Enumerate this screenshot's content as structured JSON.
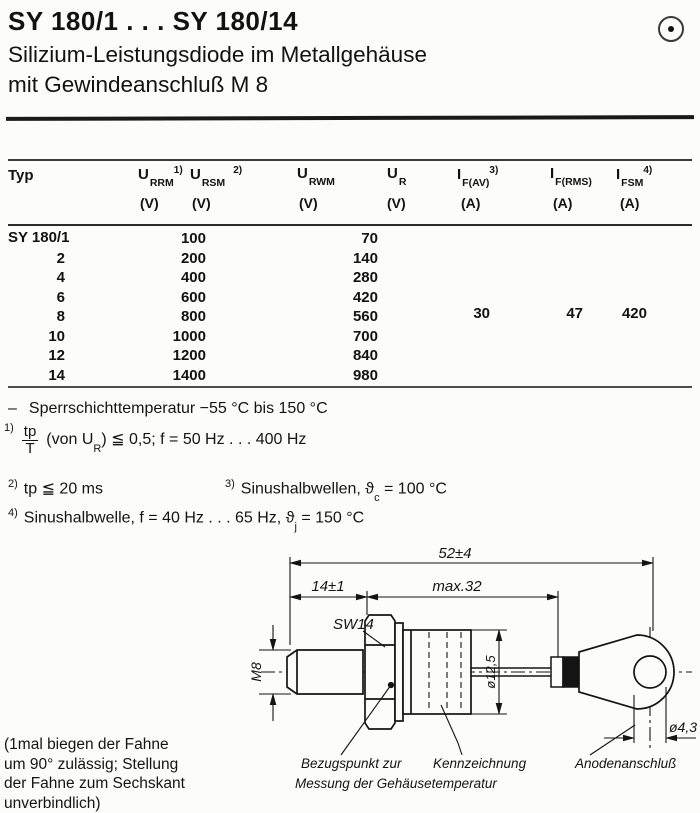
{
  "page": {
    "title": "SY 180/1 . . . SY 180/14",
    "subtitle_line1": "Silizium-Leistungsdiode im Metallgehäuse",
    "subtitle_line2": "mit Gewindeanschluß M 8"
  },
  "table": {
    "col_typ": "Typ",
    "headers": [
      {
        "main": "U",
        "sub": "RRM",
        "sup": "1)",
        "unit": "(V)"
      },
      {
        "main": "U",
        "sub": "RSM",
        "sup": "2)",
        "unit": "(V)"
      },
      {
        "main": "U",
        "sub": "RWM",
        "unit": "(V)"
      },
      {
        "main": "U",
        "sub": "R",
        "unit": "(V)"
      },
      {
        "main": "I",
        "sub": "F(AV)",
        "sup": "3)",
        "unit": "(A)"
      },
      {
        "main": "I",
        "sub": "F(RMS)",
        "unit": "(A)"
      },
      {
        "main": "I",
        "sub": "FSM",
        "sup": "4)",
        "unit": "(A)"
      }
    ],
    "type_first": "SY 180/1",
    "types_rest": [
      "2",
      "4",
      "6",
      "8",
      "10",
      "12",
      "14"
    ],
    "u_rrm_rsm": [
      "100",
      "200",
      "400",
      "600",
      "800",
      "1000",
      "1200",
      "1400"
    ],
    "u_rwm_r": [
      "70",
      "140",
      "280",
      "420",
      "560",
      "700",
      "840",
      "980"
    ],
    "i_fav": "30",
    "i_frms": "47",
    "i_fsm": "420"
  },
  "notes": {
    "temp_dash": "–",
    "temp": "Sperrschichttemperatur  −55 °C bis 150 °C",
    "n1_sup": "1)",
    "n1_num": "tp",
    "n1_den": "T",
    "n1_a": "(von U",
    "n1_sub": "R",
    "n1_b": ")  ≦  0,5;  f = 50 Hz . . . 400 Hz",
    "n2_sup": "2)",
    "n2": "tp ≦ 20 ms",
    "n3_sup": "3)",
    "n3_a": "Sinushalbwellen,  ϑ",
    "n3_sub": "c",
    "n3_b": " = 100 °C",
    "n4_sup": "4)",
    "n4_a": "Sinushalbwelle, f = 40 Hz . . . 65 Hz,  ϑ",
    "n4_sub": "j",
    "n4_b": "  = 150 °C"
  },
  "drawing": {
    "dim_overall": "52±4",
    "dim_thread": "14±1",
    "dim_body": "max.32",
    "wrench": "SW14",
    "thread": "M8",
    "dia_body": "ø12,5",
    "dia_hole": "ø4,3",
    "label_ref_1": "Bezugspunkt zur",
    "label_ref_2": "Messung der Gehäusetemperatur",
    "label_marking": "Kennzeichnung",
    "label_anode": "Anodenanschluß",
    "flag_note_lines": [
      "(1mal biegen der Fahne",
      "um 90° zulässig; Stellung",
      "der Fahne zum Sechskant",
      "unverbindlich)"
    ]
  }
}
